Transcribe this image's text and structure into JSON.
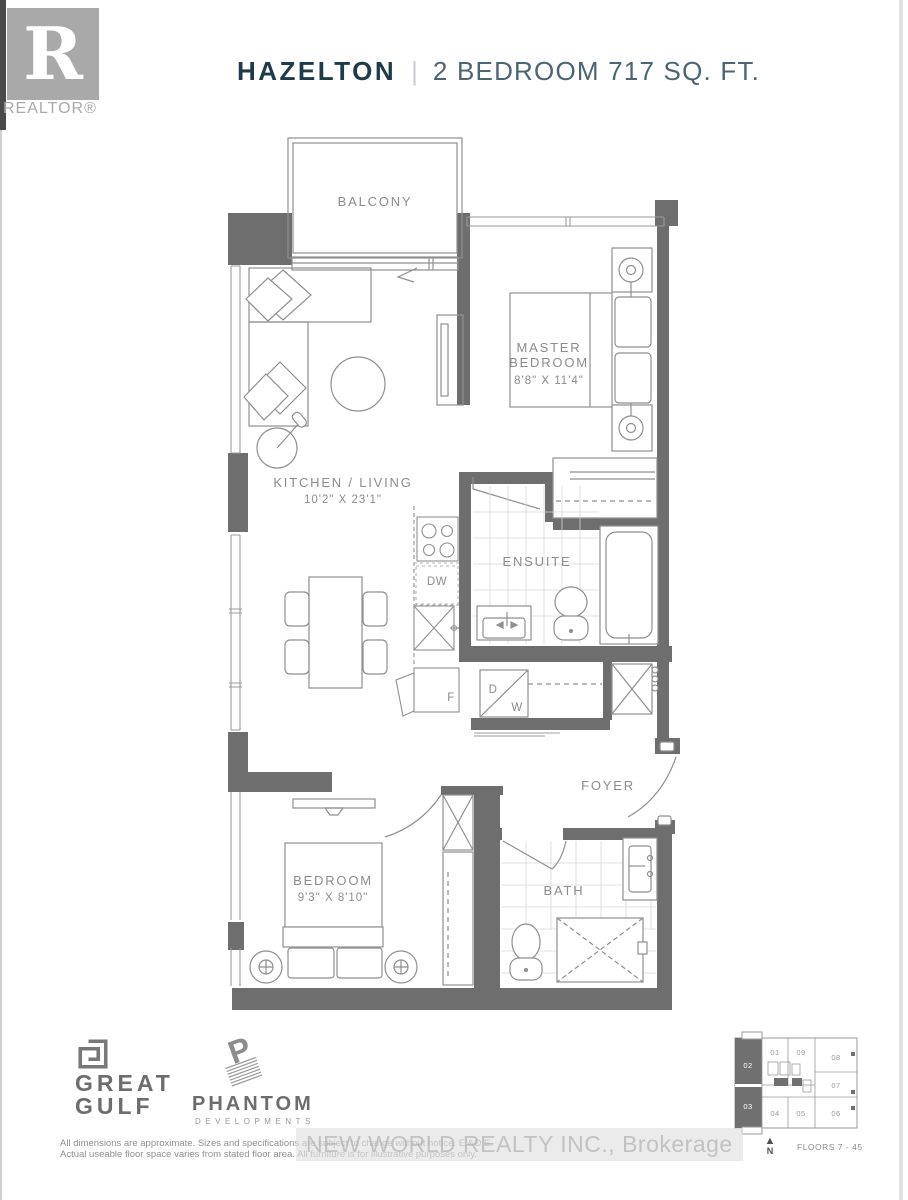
{
  "colors": {
    "wall": "#6e6e6e",
    "line": "#8f8f8f",
    "window": "#9a9a9a",
    "tile": "#d4d4d4",
    "title": "#1e3b49",
    "subtitle": "#4b6572",
    "logo_gray": "#a9a9a9"
  },
  "header": {
    "realtor_letter": "R",
    "realtor_label": "REALTOR®",
    "title": "HAZELTON",
    "divider": "|",
    "subtitle": "2 BEDROOM 717 SQ. FT."
  },
  "plan": {
    "balcony": "BALCONY",
    "master_l1": "MASTER",
    "master_l2": "BEDROOM",
    "master_dims": "8'8\" X 11'4\"",
    "kitchen_living": "KITCHEN / LIVING",
    "kitchen_dims": "10'2\" X 23'1\"",
    "ensuite": "ENSUITE",
    "foyer": "FOYER",
    "bath": "BATH",
    "bedroom": "BEDROOM",
    "bedroom_dims": "9'3\" X 8'10\"",
    "dishwasher": "DW",
    "fridge": "F",
    "dryer": "D",
    "washer": "W"
  },
  "footer": {
    "great_gulf_l1": "GREAT",
    "great_gulf_l2": "GULF",
    "phantom": "PHANTOM",
    "phantom_sub": "DEVELOPMENTS",
    "disclaimer_l1": "All dimensions are approximate. Sizes and specifications are subject to change without notice. E.&O.E.",
    "disclaimer_l2": "Actual useable floor space varies from stated floor area. All furniture is for illustrative purposes only.",
    "watermark": "NEW WORLD REALTY INC., Brokerage",
    "keyplan": {
      "u01": "01",
      "u02": "02",
      "u03": "03",
      "u04": "04",
      "u05": "05",
      "u06": "06",
      "u07": "07",
      "u08": "08",
      "u09": "09",
      "north": "N",
      "floors": "FLOORS 7 - 45"
    }
  }
}
